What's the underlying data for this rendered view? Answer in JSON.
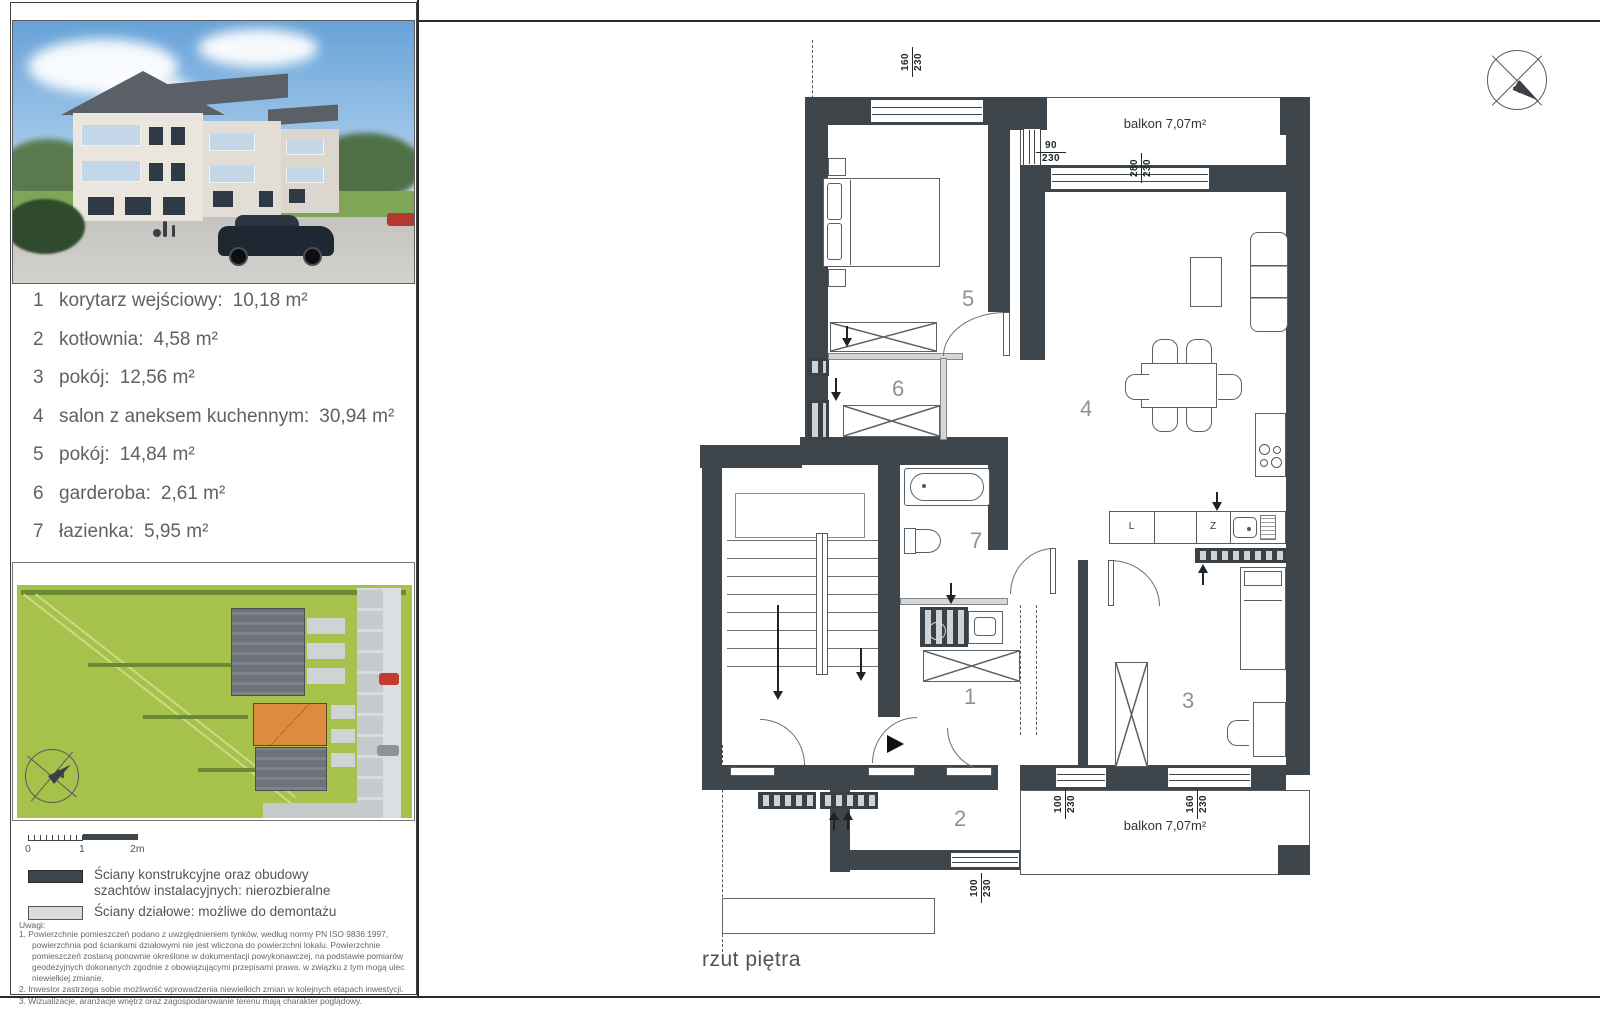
{
  "left_panel": {
    "rooms": [
      {
        "num": "1",
        "name": "korytarz wejściowy:",
        "area": "10,18 m²"
      },
      {
        "num": "2",
        "name": "kotłownia:",
        "area": "4,58 m²"
      },
      {
        "num": "3",
        "name": "pokój:",
        "area": "12,56 m²"
      },
      {
        "num": "4",
        "name": "salon z aneksem kuchennym:",
        "area": "30,94 m²"
      },
      {
        "num": "5",
        "name": "pokój:",
        "area": "14,84 m²"
      },
      {
        "num": "6",
        "name": "garderoba:",
        "area": "2,61 m²"
      },
      {
        "num": "7",
        "name": "łazienka:",
        "area": "5,95 m²"
      }
    ],
    "scale_labels": {
      "zero": "0",
      "one": "1",
      "two": "2m"
    },
    "legend": {
      "dark_line1": "Ściany konstrukcyjne oraz obudowy",
      "dark_line2": "szachtów instalacyjnych: nierozbieralne",
      "light_line1": "Ściany działowe: możliwe do demontażu"
    },
    "notes_title": "Uwagi:",
    "notes": [
      "1.  Powierzchnie pomieszczeń podano z uwzględnieniem tynków, według normy PN ISO 9836:1997, powierzchnia pod ściankami działowymi nie jest wliczona do powierzchni lokalu. Powierzchnie pomieszczeń zostaną ponownie określone w dokumentacji powykonawczej, na podstawie pomiarów geodezyjnych dokonanych zgodnie z obowiązującymi przepisami prawa. w związku z tym mogą ulec niewielkiej zmianie.",
      "2.  Inwestor zastrzega sobie możliwość wprowadzenia niewielkich zmian w kolejnych etapach inwestycji.",
      "3.  Wizualizacje, aranżacje wnętrz oraz zagospodarowanie terenu mają charakter poglądowy."
    ],
    "site_compass": "N"
  },
  "plan": {
    "caption": "rzut piętra",
    "balcony_top": "balkon 7,07m²",
    "balcony_bottom": "balkon 7,07m²",
    "rooms": {
      "r1": "1",
      "r2": "2",
      "r3": "3",
      "r4": "4",
      "r5": "5",
      "r6": "6",
      "r7": "7"
    },
    "dims": [
      {
        "w": "160",
        "h": "230"
      },
      {
        "w": "90",
        "h": "230"
      },
      {
        "w": "280",
        "h": "230"
      },
      {
        "w": "100",
        "h": "230"
      },
      {
        "w": "160",
        "h": "230"
      },
      {
        "w": "100",
        "h": "230"
      }
    ],
    "kitchen": {
      "left_cabinet": "L",
      "right_cabinet": "Z"
    },
    "north_label": "N"
  },
  "colors": {
    "wall_dark": "#3e464c",
    "partition_light": "#d4d6d8",
    "site_green": "#a7c24a",
    "accent_orange": "#dd8c3e"
  }
}
